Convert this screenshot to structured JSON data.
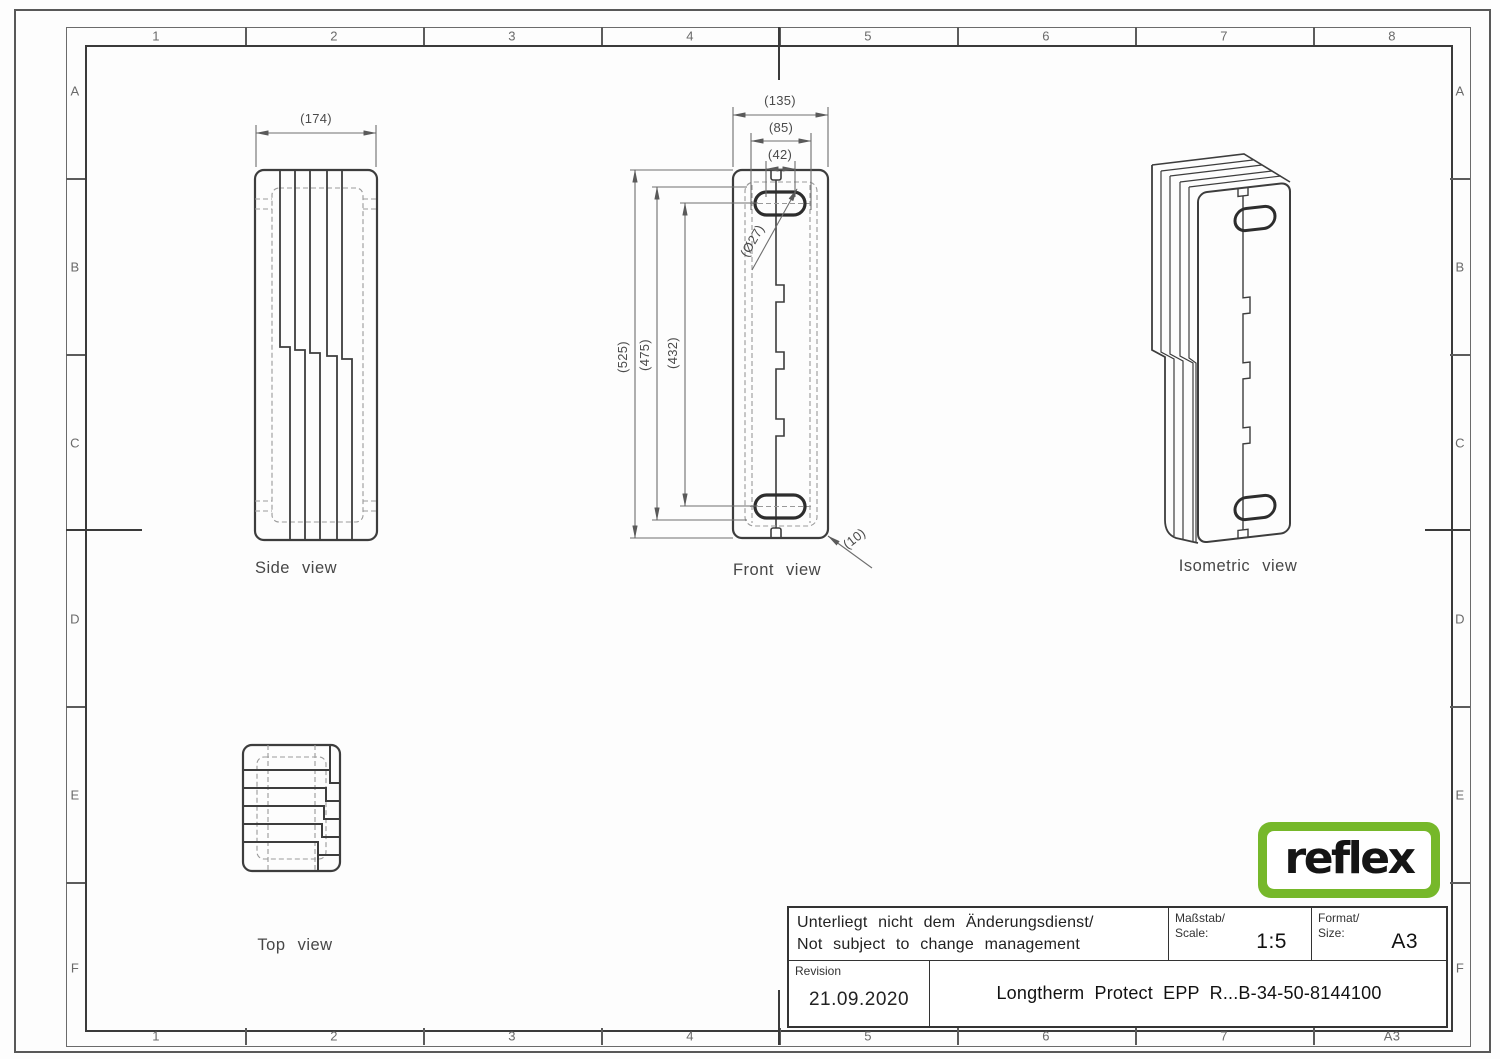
{
  "sheet": {
    "frame": {
      "columns_top": [
        "1",
        "2",
        "3",
        "4",
        "5",
        "6",
        "7",
        "8"
      ],
      "columns_bottom": [
        "1",
        "2",
        "3",
        "4",
        "5",
        "6",
        "7",
        "A3"
      ],
      "rows_left": [
        "A",
        "B",
        "C",
        "D",
        "E",
        "F"
      ],
      "rows_right": [
        "A",
        "B",
        "C",
        "D",
        "E",
        "F"
      ]
    },
    "views": {
      "side": {
        "label": "Side view",
        "width_dim": "(174)"
      },
      "front": {
        "label": "Front view",
        "dims": {
          "overall_width": "(135)",
          "port_pitch_w": "(85)",
          "slot_width": "(42)",
          "overall_height": "(525)",
          "body_height": "(475)",
          "port_pitch_h": "(432)",
          "port_diameter": "(Ø27)",
          "edge_radius": "(10)"
        }
      },
      "isometric": {
        "label": "Isometric view"
      },
      "top": {
        "label": "Top view"
      }
    },
    "title_block": {
      "change_note_de": "Unterliegt nicht dem Änderungsdienst/",
      "change_note_en": "Not subject to change management",
      "scale_label_de": "Maßstab/",
      "scale_label_en": "Scale:",
      "scale_value": "1:5",
      "format_label_de": "Format/",
      "format_label_en": "Size:",
      "format_value": "A3",
      "revision_label": "Revision",
      "revision_date": "21.09.2020",
      "part_title": "Longtherm Protect EPP R...B-34-50-8144100"
    },
    "logo": {
      "text": "reflex",
      "color": "#76b82a"
    }
  }
}
